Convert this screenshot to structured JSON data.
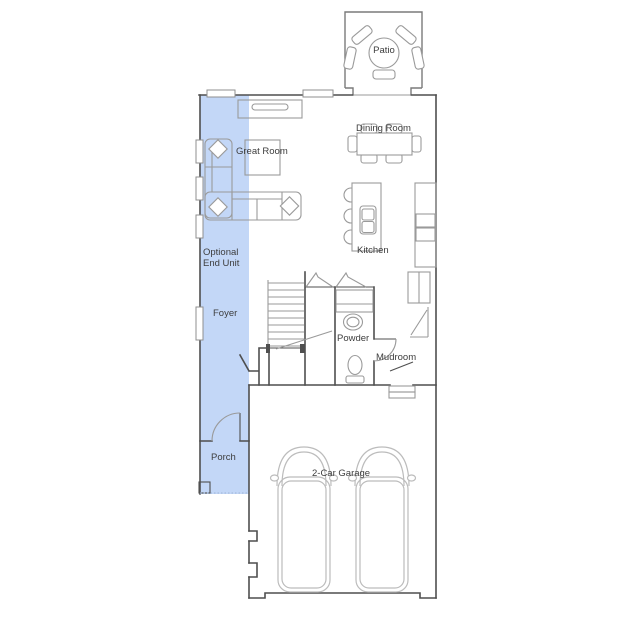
{
  "colors": {
    "highlight": "#c3d7f7",
    "wall": "#4f4f4f",
    "furniture": "#9a9a9a",
    "car": "#bcbcbc",
    "patio_wall": "#7a7a7a",
    "text": "#3d3d3d"
  },
  "rooms": {
    "patio": {
      "label": "Patio"
    },
    "dining_room": {
      "label": "Dining Room"
    },
    "great_room": {
      "label": "Great Room"
    },
    "kitchen": {
      "label": "Kitchen"
    },
    "optional_end_unit": {
      "label": "Optional End Unit"
    },
    "foyer": {
      "label": "Foyer"
    },
    "powder": {
      "label": "Powder"
    },
    "mudroom": {
      "label": "Mudroom"
    },
    "porch": {
      "label": "Porch"
    },
    "garage": {
      "label": "2-Car Garage"
    }
  }
}
